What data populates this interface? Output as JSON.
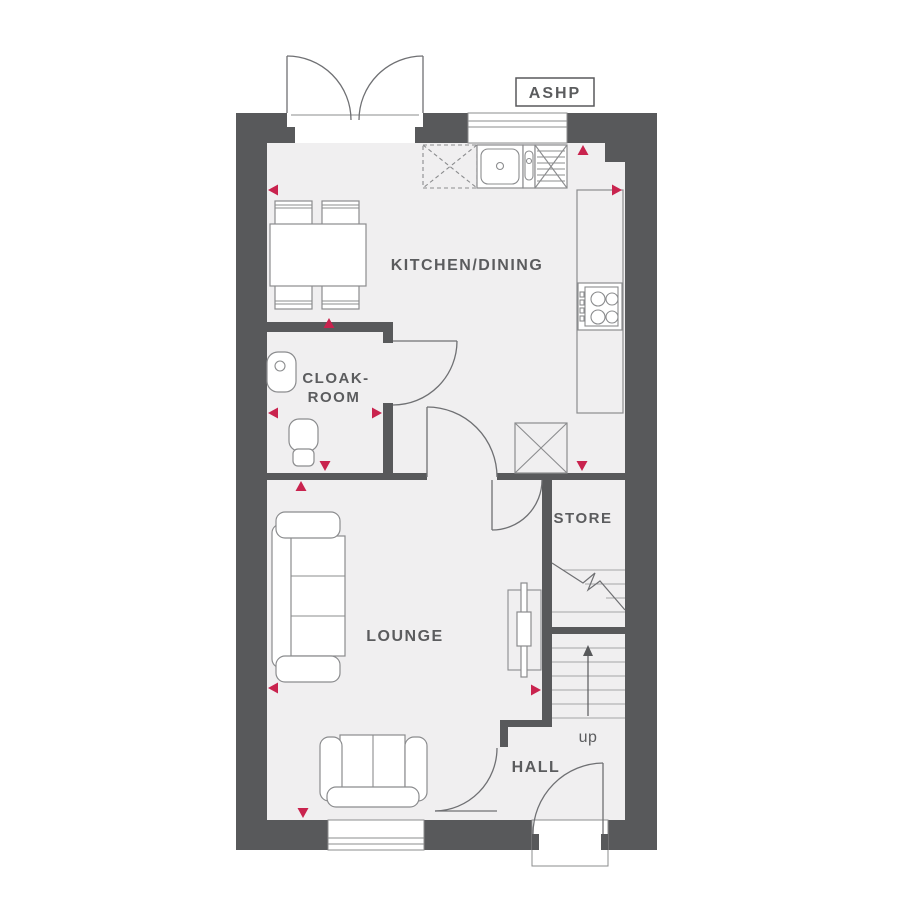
{
  "labels": {
    "ashp": "ASHP",
    "kitchen_dining": "KITCHEN/DINING",
    "cloakroom_line1": "CLOAK-",
    "cloakroom_line2": "ROOM",
    "store": "STORE",
    "lounge": "LOUNGE",
    "hall": "HALL",
    "stairs_up": "up"
  },
  "colors": {
    "background": "#ffffff",
    "wall": "#58595b",
    "floor": "#f0eff0",
    "accent_marker": "#c9234e",
    "furniture_line": "#8b8c8e",
    "door_line": "#6f7073",
    "text": "#5b5c5e"
  }
}
